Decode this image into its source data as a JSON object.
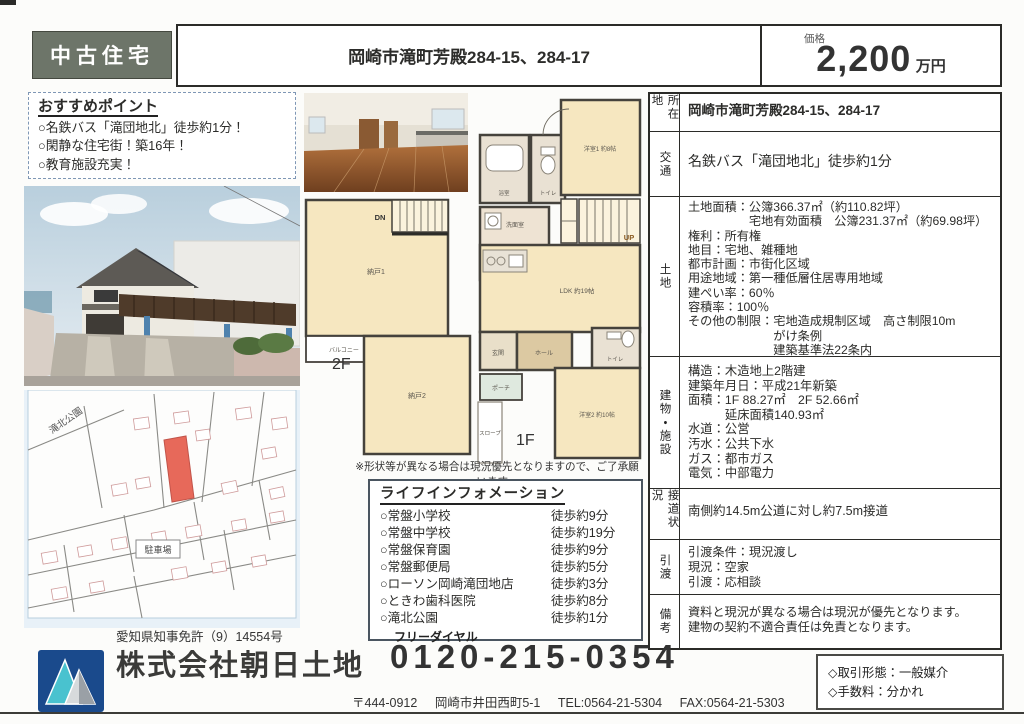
{
  "header": {
    "category": "中古住宅",
    "title": "岡崎市滝町芳殿284-15、284-17",
    "price": {
      "label": "価格",
      "value": "2,200",
      "unit": "万円"
    }
  },
  "recommend": {
    "title": "おすすめポイント",
    "points": [
      "○名鉄バス「滝団地北」徒歩約1分！",
      "○閑静な住宅街！築16年！",
      "○教育施設充実！"
    ]
  },
  "floorplan": {
    "floor2_label": "2F",
    "floor1_label": "1F",
    "rooms": {
      "dn": "DN",
      "up": "UP",
      "nando1": "納戸1",
      "nando2": "納戸2",
      "balcony": "バルコニー",
      "bath": "浴室",
      "toilet": "トイレ",
      "senmen": "洗面室",
      "youshitsu1": "洋室1 約8帖",
      "ldk": "LDK 約19帖",
      "genkan": "玄関",
      "hall": "ホール",
      "youshitsu2": "洋室2 約10帖",
      "porch": "ポーチ",
      "slope": "スロープ"
    },
    "note": "※形状等が異なる場合は現況優先となりますので、ご了承願います。"
  },
  "life_info": {
    "title": "ライフインフォメーション",
    "items": [
      {
        "name": "○常盤小学校",
        "time": "徒歩約9分"
      },
      {
        "name": "○常盤中学校",
        "time": "徒歩約19分"
      },
      {
        "name": "○常盤保育園",
        "time": "徒歩約9分"
      },
      {
        "name": "○常盤郵便局",
        "time": "徒歩約5分"
      },
      {
        "name": "○ローソン岡崎滝団地店",
        "time": "徒歩約3分"
      },
      {
        "name": "○ときわ歯科医院",
        "time": "徒歩約8分"
      },
      {
        "name": "○滝北公園",
        "time": "徒歩約1分"
      }
    ]
  },
  "details": {
    "rows": [
      {
        "label": "所在地",
        "lines": [
          "岡崎市滝町芳殿284-15、284-17"
        ]
      },
      {
        "label": "交通",
        "lines": [
          "名鉄バス「滝団地北」徒歩約1分"
        ]
      },
      {
        "label": "土地",
        "lines": [
          "土地面積：公簿366.37㎡（約110.82坪）",
          "　　　　　宅地有効面積　公簿231.37㎡（約69.98坪）",
          "権利：所有権",
          "地目：宅地、雑種地",
          "都市計画：市街化区域",
          "用途地域：第一種低層住居専用地域",
          "建ぺい率：60％",
          "容積率：100％",
          "その他の制限：宅地造成規制区域　高さ制限10m",
          "　　　　　　　がけ条例",
          "　　　　　　　建築基準法22条内"
        ]
      },
      {
        "label": "建物・施設",
        "lines": [
          "構造：木造地上2階建",
          "建築年月日：平成21年新築",
          "面積：1F 88.27㎡　2F 52.66㎡",
          "　　　延床面積140.93㎡",
          "水道：公営",
          "汚水：公共下水",
          "ガス：都市ガス",
          "電気：中部電力"
        ]
      },
      {
        "label": "接道状況",
        "lines": [
          "南側約14.5m公道に対し約7.5m接道"
        ]
      },
      {
        "label": "引渡",
        "lines": [
          "引渡条件：現況渡し",
          "現況：空家",
          "引渡：応相談"
        ]
      },
      {
        "label": "備考",
        "lines": [
          "資料と現況が異なる場合は現況が優先となります。",
          "建物の契約不適合責任は免責となります。"
        ]
      }
    ]
  },
  "map": {
    "park_label": "滝北公園",
    "parking_label": "駐車場"
  },
  "footer": {
    "license": "愛知県知事免許（9）14554号",
    "company": "株式会社朝日土地",
    "freedial_label": "フリーダイヤル",
    "phone": "0120-215-0354",
    "postal": "〒444-0912",
    "address": "岡崎市井田西町5-1",
    "tel": "TEL:0564-21-5304",
    "fax": "FAX:0564-21-5303",
    "deal_type": "◇取引形態：一般媒介",
    "fee": "◇手数料：分かれ"
  },
  "colors": {
    "category_bg": "#6d7569",
    "room_cream": "#f6e7c0",
    "parcel_red": "#e7695a",
    "logo_blue": "#1a4a8c",
    "logo_teal": "#49c2cf"
  }
}
